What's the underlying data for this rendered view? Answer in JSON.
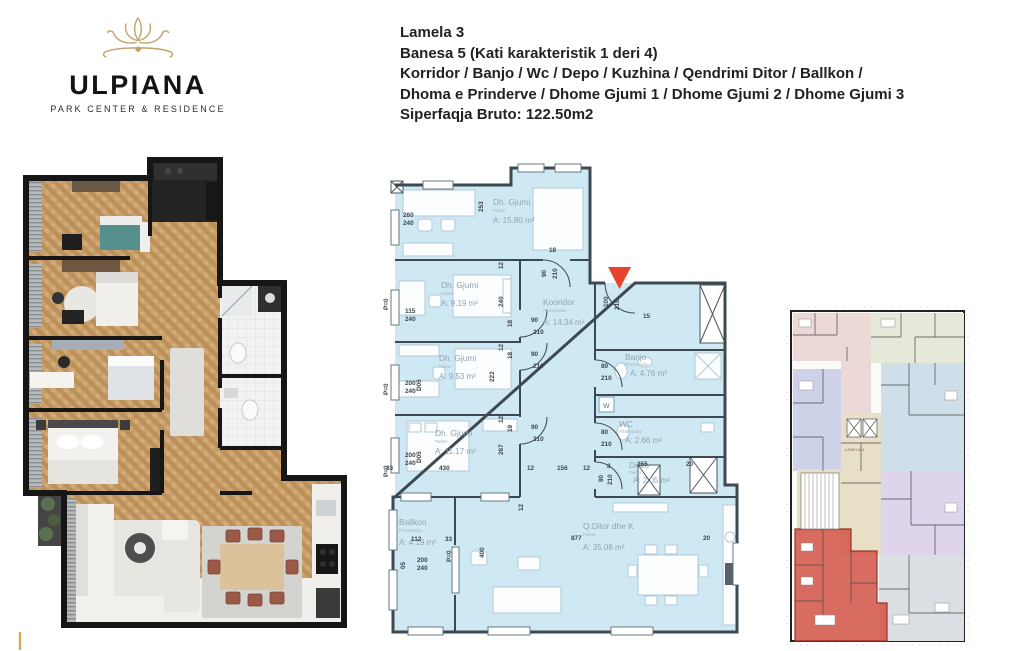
{
  "logo": {
    "brand": "ULPIANA",
    "tagline": "PARK CENTER & RESIDENCE",
    "icon": "lotus-flower"
  },
  "header": {
    "lines": [
      "Lamela 3",
      "Banesa 5 (Kati karakteristik 1 deri 4)",
      "Korridor / Banjo / Wc / Depo / Kuzhina / Qendrimi Ditor / Ballkon /",
      "Dhoma e Prinderve / Dhome Gjumi 1 / Dhome Gjumi 2 / Dhome Gjumi 3",
      "Siperfaqja Bruto: 122.50m2"
    ]
  },
  "plan2d": {
    "rooms": [
      {
        "name": "Dh. Gjumi",
        "floor": "Parket",
        "area": "A: 15.80 m²"
      },
      {
        "name": "Dh. Gjumi",
        "floor": "Parket",
        "area": "A: 9.19 m²"
      },
      {
        "name": "Dh. Gjumi",
        "floor": "Parket",
        "area": "A: 9.53 m²"
      },
      {
        "name": "Dh. Gjumi",
        "floor": "Parket",
        "area": "A: 11.17 m²"
      },
      {
        "name": "Kooridor",
        "floor": "Pll.Keramike",
        "area": "A: 14.34 m²"
      },
      {
        "name": "Banjo",
        "floor": "Pll.Keramike",
        "area": "A: 4.76 m²"
      },
      {
        "name": "WC",
        "floor": "Pll.keramike",
        "area": "A: 2.66 m²"
      },
      {
        "name": "Depo",
        "floor": "Parket",
        "area": "A: 2.05 m²"
      },
      {
        "name": "Ballkon",
        "floor": "Pll.Keramike",
        "area": "A: 4.19 m²"
      },
      {
        "name": "Q.Ditor dhe K",
        "floor": "Parket",
        "area": "A: 35.08 m²"
      }
    ],
    "washer_label": "W",
    "dims": [
      {
        "t": "260",
        "x": 20,
        "y": 62
      },
      {
        "t": "240",
        "x": 20,
        "y": 70
      },
      {
        "t": "253",
        "x": 100,
        "y": 57,
        "r": 1
      },
      {
        "t": "18",
        "x": 166,
        "y": 97
      },
      {
        "t": "90",
        "x": 163,
        "y": 122,
        "r": 1
      },
      {
        "t": "210",
        "x": 174,
        "y": 124,
        "r": 1
      },
      {
        "t": "12",
        "x": 120,
        "y": 114,
        "r": 1
      },
      {
        "t": "115",
        "x": 22,
        "y": 158
      },
      {
        "t": "240",
        "x": 22,
        "y": 166
      },
      {
        "t": "240",
        "x": 120,
        "y": 152,
        "r": 1
      },
      {
        "t": "18",
        "x": 129,
        "y": 172,
        "r": 1
      },
      {
        "t": "90",
        "x": 148,
        "y": 167
      },
      {
        "t": "210",
        "x": 150,
        "y": 179
      },
      {
        "t": "12",
        "x": 120,
        "y": 196,
        "r": 1
      },
      {
        "t": "200",
        "x": 22,
        "y": 230
      },
      {
        "t": "240",
        "x": 22,
        "y": 238
      },
      {
        "t": "D05",
        "x": 38,
        "y": 236,
        "r": 1
      },
      {
        "t": "222",
        "x": 111,
        "y": 227,
        "r": 1
      },
      {
        "t": "18",
        "x": 129,
        "y": 204,
        "r": 1
      },
      {
        "t": "90",
        "x": 148,
        "y": 201
      },
      {
        "t": "210",
        "x": 150,
        "y": 213
      },
      {
        "t": "12",
        "x": 120,
        "y": 268,
        "r": 1
      },
      {
        "t": "200",
        "x": 22,
        "y": 302
      },
      {
        "t": "240",
        "x": 22,
        "y": 310
      },
      {
        "t": "D05",
        "x": 38,
        "y": 308,
        "r": 1
      },
      {
        "t": "267",
        "x": 120,
        "y": 300,
        "r": 1
      },
      {
        "t": "19",
        "x": 129,
        "y": 277,
        "r": 1
      },
      {
        "t": "90",
        "x": 148,
        "y": 274
      },
      {
        "t": "210",
        "x": 150,
        "y": 286
      },
      {
        "t": "33",
        "x": 3,
        "y": 315
      },
      {
        "t": "430",
        "x": 56,
        "y": 315
      },
      {
        "t": "12",
        "x": 144,
        "y": 315
      },
      {
        "t": "156",
        "x": 174,
        "y": 315
      },
      {
        "t": "12",
        "x": 200,
        "y": 315
      },
      {
        "t": "100",
        "x": 225,
        "y": 152,
        "r": 1
      },
      {
        "t": "210",
        "x": 236,
        "y": 155,
        "r": 1
      },
      {
        "t": "15",
        "x": 260,
        "y": 163
      },
      {
        "t": "80",
        "x": 218,
        "y": 213
      },
      {
        "t": "210",
        "x": 218,
        "y": 225
      },
      {
        "t": "80",
        "x": 218,
        "y": 279
      },
      {
        "t": "210",
        "x": 218,
        "y": 291
      },
      {
        "t": "80",
        "x": 220,
        "y": 327,
        "r": 1
      },
      {
        "t": "210",
        "x": 229,
        "y": 330,
        "r": 1
      },
      {
        "t": "8",
        "x": 224,
        "y": 313
      },
      {
        "t": "255",
        "x": 254,
        "y": 311
      },
      {
        "t": "20",
        "x": 303,
        "y": 311
      },
      {
        "t": "877",
        "x": 188,
        "y": 385
      },
      {
        "t": "20",
        "x": 320,
        "y": 385
      },
      {
        "t": "400",
        "x": 101,
        "y": 403,
        "r": 1
      },
      {
        "t": "12",
        "x": 140,
        "y": 356,
        "r": 1
      },
      {
        "t": "112",
        "x": 28,
        "y": 386
      },
      {
        "t": "33",
        "x": 62,
        "y": 386
      },
      {
        "t": "200",
        "x": 34,
        "y": 407
      },
      {
        "t": "240",
        "x": 34,
        "y": 415
      },
      {
        "t": "05",
        "x": 22,
        "y": 414,
        "r": 1
      },
      {
        "t": "P=0",
        "x": 68,
        "y": 407,
        "r": 1
      },
      {
        "t": "P=0",
        "x": 5,
        "y": 155,
        "r": 1
      },
      {
        "t": "P=0",
        "x": 5,
        "y": 240,
        "r": 1
      },
      {
        "t": "P=0",
        "x": 5,
        "y": 322,
        "r": 1
      }
    ]
  },
  "building": {
    "core_label": "LAMELA 3",
    "highlighted_unit": "Banesa 5"
  },
  "colors": {
    "brand_gold": "#c2a169",
    "plan_fill": "#cfe9f4",
    "wall": "#3d4950",
    "entry_marker_red": "#e8432c",
    "unit_highlight_red": "#d4584a",
    "unit_green": "#e6e9d9",
    "unit_pink": "#ecd9d7",
    "unit_lavender": "#cdd2e8",
    "unit_blue": "#cfdfe9",
    "unit_purple": "#ded4eb",
    "unit_gray": "#dbdee3",
    "core_beige": "#e7dfc6"
  }
}
